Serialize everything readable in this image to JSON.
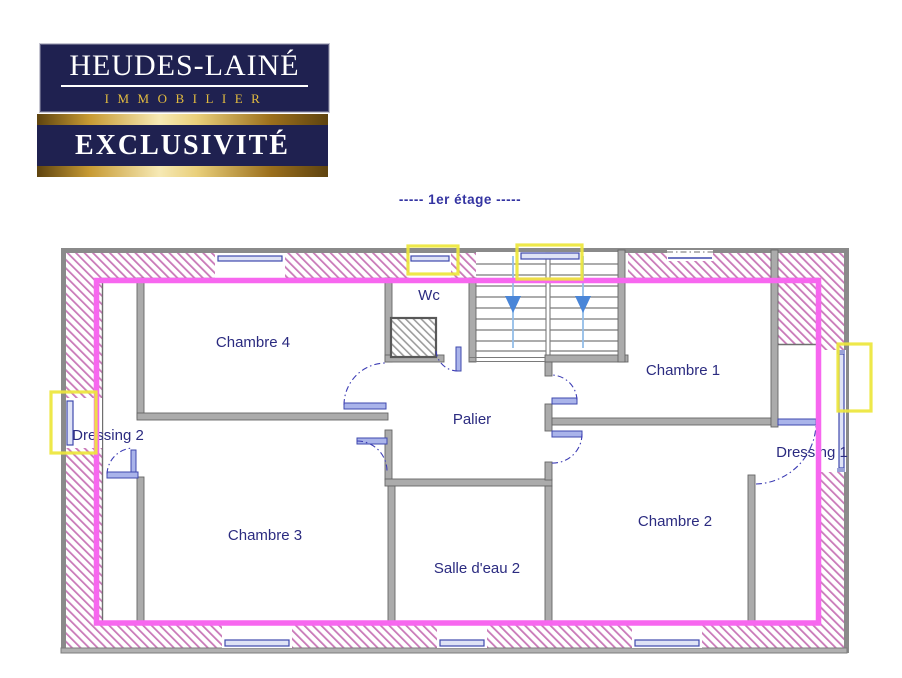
{
  "logo": {
    "name": "HEUDES-LAINÉ",
    "tagline": "IMMOBILIER",
    "banner": "EXCLUSIVITÉ"
  },
  "plan": {
    "title": "-----  1er étage  -----",
    "rooms": [
      {
        "label": "Chambre 4"
      },
      {
        "label": "Wc"
      },
      {
        "label": "Chambre 1"
      },
      {
        "label": "Palier"
      },
      {
        "label": "Dressing 2"
      },
      {
        "label": "Dressing 1"
      },
      {
        "label": "Chambre 3"
      },
      {
        "label": "Salle d'eau 2"
      },
      {
        "label": "Chambre 2"
      }
    ],
    "colors": {
      "floor_outline": "#F767EF",
      "window_highlight": "#EDE63B",
      "wall_hatch": "#C979B8",
      "label": "#2B2B80",
      "door_blue": "#3F49AE",
      "stairs_arrow": "#4A86D8"
    }
  }
}
